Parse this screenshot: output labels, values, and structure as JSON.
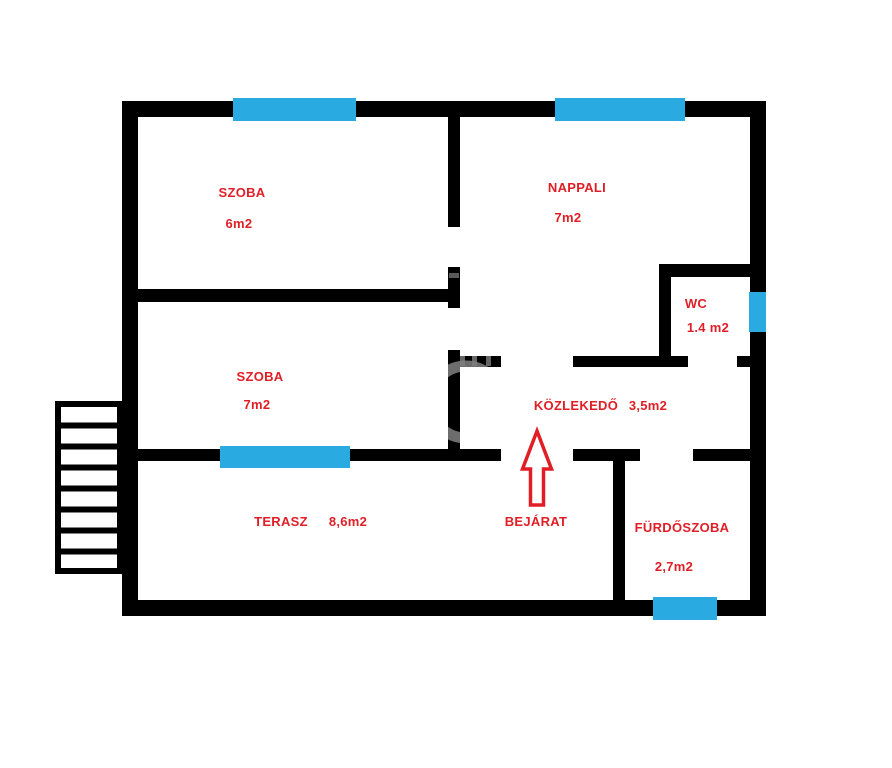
{
  "plan": {
    "type": "floor-plan",
    "colors": {
      "wall": "#000000",
      "window": "#29ABE2",
      "label": "#E01E26",
      "background": "#FFFFFF"
    },
    "rooms": [
      {
        "name": "SZOBA",
        "area": "6m2"
      },
      {
        "name": "NAPPALI",
        "area": "7m2"
      },
      {
        "name": "WC",
        "area": "1.4 m2"
      },
      {
        "name": "SZOBA",
        "area": "7m2"
      },
      {
        "name": "KÖZLEKEDŐ",
        "area": "3,5m2"
      },
      {
        "name": "TERASZ",
        "area": "8,6m2"
      },
      {
        "name": "FÜRDŐSZOBA",
        "area": "2,7m2"
      }
    ],
    "entrance": {
      "label": "BEJÁRAT",
      "arrow_icon": "up-arrow-icon",
      "arrow_direction": "up"
    },
    "window_count": 5,
    "stairs_steps": 8
  }
}
